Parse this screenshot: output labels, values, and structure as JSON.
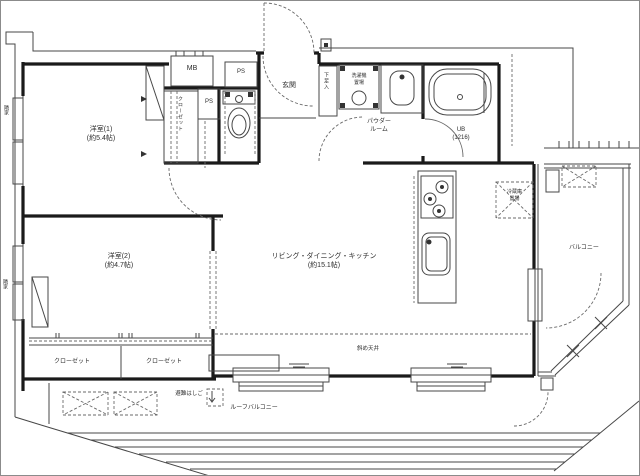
{
  "colors": {
    "background": "#ffffff",
    "wall_line": "#1a1a1a",
    "thin_line": "#474747",
    "dashed_line": "#6a6a6a"
  },
  "rooms": {
    "bedroom1": {
      "name": "洋室(1)",
      "size": "(約5.4帖)"
    },
    "bedroom2": {
      "name": "洋室(2)",
      "size": "(約4.7帖)"
    },
    "ldk": {
      "name": "リビング・ダイニング・キッチン",
      "size": "(約15.1帖)"
    },
    "entrance": {
      "name": "玄関"
    },
    "powder_room": {
      "line1": "パウダー",
      "line2": "ルーム"
    },
    "unit_bath": {
      "name": "UB",
      "size": "(1216)"
    },
    "balcony": {
      "name": "バルコニー"
    },
    "roof_balcony": {
      "name": "ルーフバルコニー"
    }
  },
  "labels": {
    "meter_box": "MB",
    "pipe_space_1": "PS",
    "pipe_space_2": "PS",
    "closet_hall": "クローゼット",
    "closet_left": "クローゼット",
    "closet_right": "クローゼット",
    "shoe_cabinet": "下足入",
    "washer_line1": "洗濯機",
    "washer_line2": "置場",
    "fridge_line1": "冷蔵庫",
    "fridge_line2": "置場",
    "escape_hatch": "避難はしご",
    "sloped_ceiling": "斜め天井",
    "neighbor_upper": "隣家",
    "neighbor_lower": "隣家"
  },
  "fixtures": [
    "toilet-icon",
    "bathtub-icon",
    "washing-machine-icon",
    "washbasin-icon",
    "gas-stove-icon",
    "kitchen-sink-icon",
    "refrigerator-space",
    "ac-outdoor-unit-space",
    "escape-ladder-hatch",
    "door-swing-arc",
    "window"
  ]
}
